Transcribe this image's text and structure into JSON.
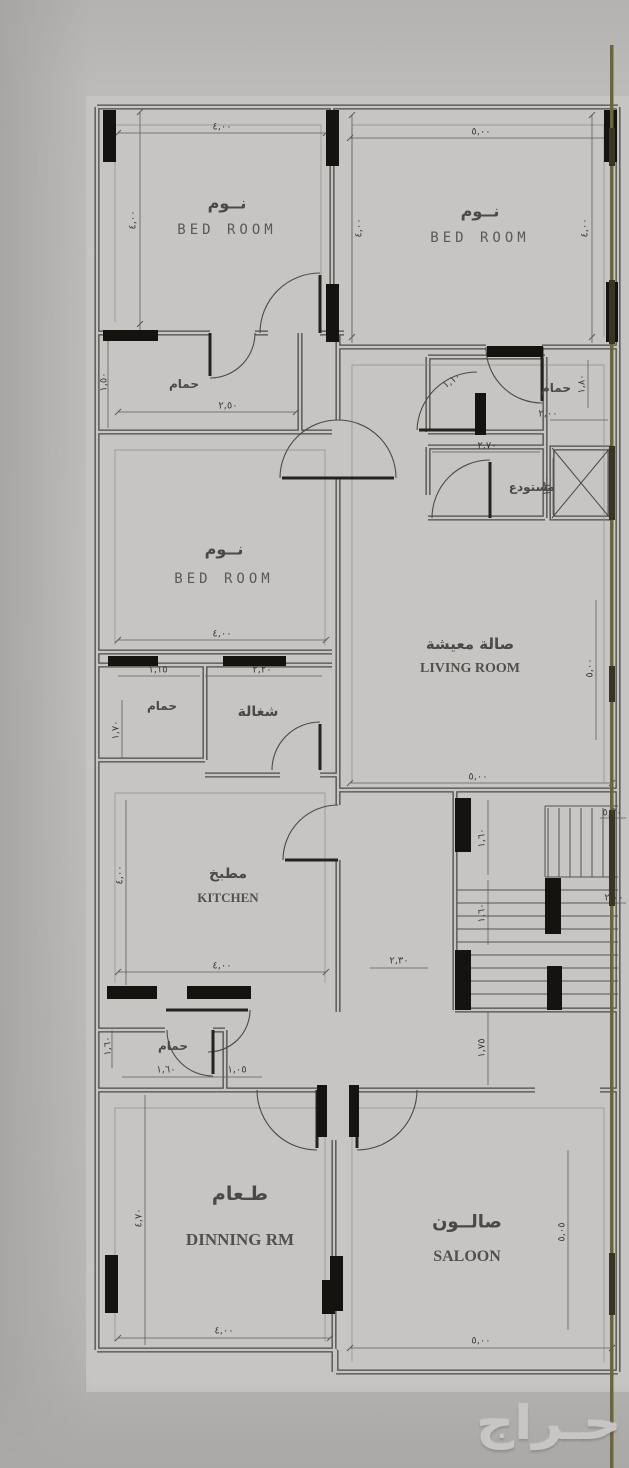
{
  "floor_plan": {
    "watermark": "حـراج",
    "rooms": [
      {
        "id": "bedroom-top-left",
        "label_ar": "نــوم",
        "label_en": "BED ROOM"
      },
      {
        "id": "bedroom-top-right",
        "label_ar": "نــوم",
        "label_en": "BED ROOM"
      },
      {
        "id": "bathroom-left",
        "label_ar": "حمام",
        "label_en": ""
      },
      {
        "id": "bathroom-right",
        "label_ar": "حمام",
        "label_en": ""
      },
      {
        "id": "storage",
        "label_ar": "مستودع",
        "label_en": ""
      },
      {
        "id": "bedroom-middle",
        "label_ar": "نــوم",
        "label_en": "BED ROOM"
      },
      {
        "id": "living-room",
        "label_ar": "صالة معيشة",
        "label_en": "LIVING ROOM"
      },
      {
        "id": "maid-bathroom",
        "label_ar": "حمام",
        "label_en": ""
      },
      {
        "id": "maid-room",
        "label_ar": "شغالة",
        "label_en": ""
      },
      {
        "id": "kitchen",
        "label_ar": "مطبخ",
        "label_en": "KITCHEN"
      },
      {
        "id": "guest-bathroom",
        "label_ar": "حمام",
        "label_en": ""
      },
      {
        "id": "dining-room",
        "label_ar": "طـعام",
        "label_en": "DINNING RM"
      },
      {
        "id": "saloon",
        "label_ar": "صالــون",
        "label_en": "SALOON"
      }
    ],
    "dimensions": [
      "٤,٠٠",
      "٥,٠٠",
      "٤,٠٠",
      "٤,٠٠",
      "٤,٠٠",
      "١,٥٠",
      "٢,٥٠",
      "١,١٠",
      "١,٨٠",
      "٢,٠٠",
      "٢,٧٠",
      "١,٣٠",
      "٤,٠٠",
      "١,١٥",
      "٢,٢٠",
      "١,٧٠",
      "٥,٠٠",
      "٥,٠٠",
      "٤,٠٠",
      "٤,٠٠",
      "٥,٢٠",
      "٢,٠٠",
      "١,٦٠",
      "١,٦٠",
      "٢,٣٠",
      "١,٧٥",
      "١,٦٠",
      "١,٦٠",
      "١,٠٥",
      "٤,٧٠",
      "٥,٠٥",
      "٤,٠٠",
      "٥,٠٠"
    ],
    "colors": {
      "paper": "#c6c5c3",
      "background": "#b8b7b5",
      "wall": "#4c4a46",
      "column": "#14130f",
      "marker_line": "#6e6535",
      "watermark": "#c7c6c4"
    }
  }
}
